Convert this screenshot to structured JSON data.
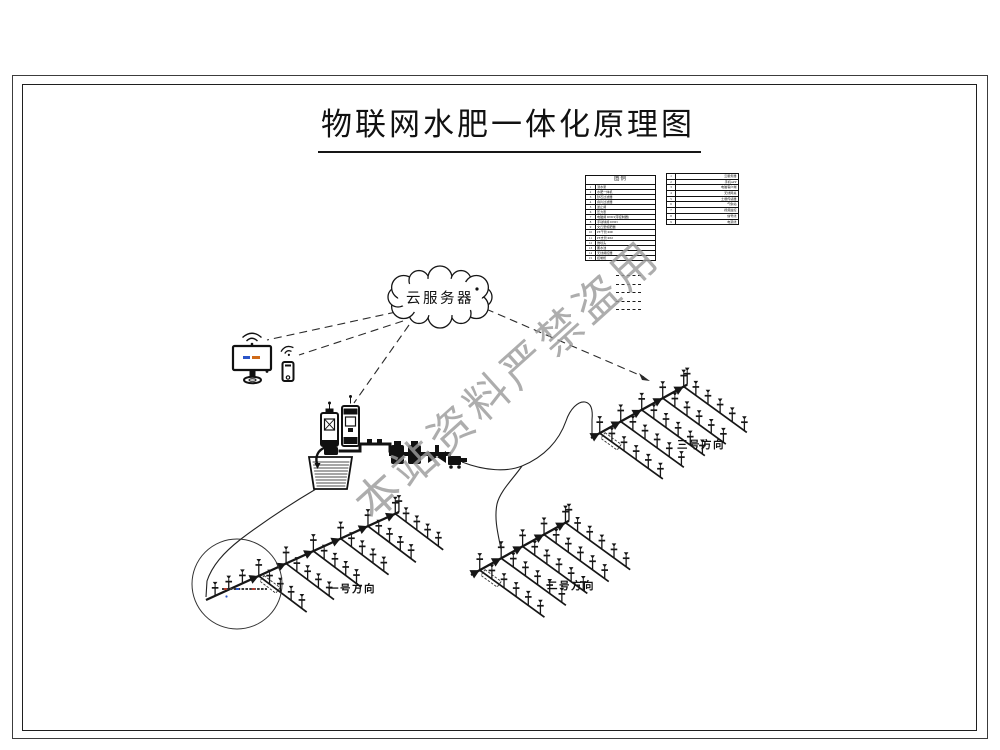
{
  "page": {
    "title": "物联网水肥一体化原理图",
    "watermark": "本站资料严禁盗用"
  },
  "cloud": {
    "label": "云服务器"
  },
  "legend": {
    "title": "图例",
    "main_rows": [
      {
        "no": "1",
        "name": "潜水泵"
      },
      {
        "no": "2",
        "name": "水肥一体机"
      },
      {
        "no": "3",
        "name": "砂石过滤器"
      },
      {
        "no": "4",
        "name": "叠片过滤器"
      },
      {
        "no": "5",
        "name": "逆止阀"
      },
      {
        "no": "6",
        "name": "压力表"
      },
      {
        "no": "7",
        "name": "电磁阀 DN63(带控制器)"
      },
      {
        "no": "8",
        "name": "手动球阀 DN63"
      },
      {
        "no": "9",
        "name": "文丘里施肥器"
      },
      {
        "no": "10",
        "name": "PE干管 Φ90"
      },
      {
        "no": "11",
        "name": "PE支管 Φ63"
      },
      {
        "no": "12",
        "name": "微喷头"
      },
      {
        "no": "13",
        "name": "蓄水池"
      },
      {
        "no": "14",
        "name": "无线阀控器"
      },
      {
        "no": "15",
        "name": "控制柜"
      }
    ],
    "secondary_rows": [
      {
        "no": "1",
        "name": "云服务器"
      },
      {
        "no": "2",
        "name": "手机APP"
      },
      {
        "no": "3",
        "name": "电脑客户端"
      },
      {
        "no": "4",
        "name": "无线网关"
      },
      {
        "no": "5",
        "name": "土壤传感器"
      },
      {
        "no": "6",
        "name": "气象站"
      },
      {
        "no": "7",
        "name": "视频监控"
      },
      {
        "no": "8",
        "name": "信号线"
      },
      {
        "no": "9",
        "name": "电源线"
      }
    ],
    "linetype_samples": [
      "— — — —",
      "— — — —",
      "— — — —",
      "— — — —",
      "— — — —"
    ]
  },
  "fields": [
    {
      "label": "一号方向"
    },
    {
      "label": "二号方向"
    },
    {
      "label": "三号方向"
    }
  ],
  "colors": {
    "ink": "#1a1a1a",
    "watermark": "#9b9b9b",
    "screen_accent_blue": "#2b55c8",
    "screen_accent_orange": "#cf6a18"
  }
}
